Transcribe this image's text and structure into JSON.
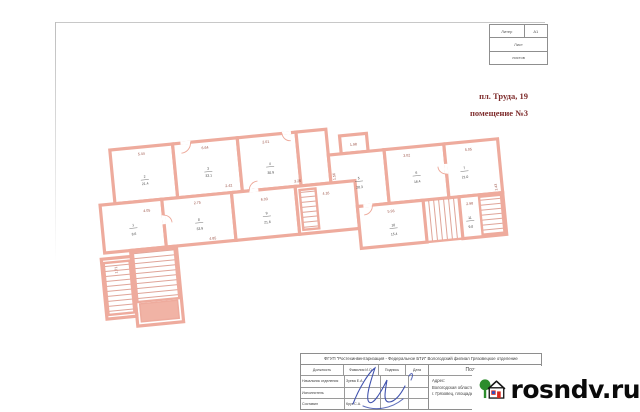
{
  "annotations": {
    "line1": "пл. Труда, 19",
    "line2": "помещение №3",
    "color": "#7f2d2d"
  },
  "stamp_table": {
    "row1_left": "Литер",
    "row1_right": "А1",
    "row2": "Лист",
    "row3": "листов"
  },
  "title_block": {
    "org": "ФГУП \"Ростехинвентаризация - Федеральное БТИ\" Вологодский филиал Грязовецкое отделение",
    "doc_title": "Поэтажный план",
    "address_label": "Адрес:",
    "address_line1": "Вологодская область,",
    "address_line2": "г. Грязовец, площадь Труда, 19",
    "col_headers": [
      "Должность",
      "Фамилия И.О.",
      "Подпись",
      "Дата"
    ],
    "rows": [
      {
        "role": "Начальник отделения",
        "name": "Зуева Е.А.",
        "date": ""
      },
      {
        "role": "Исполнитель",
        "name": "",
        "date": ""
      },
      {
        "role": "Составил",
        "name": "Круг С.А.",
        "date": ""
      }
    ]
  },
  "watermark": {
    "text": "rosndv.ru",
    "tree_color": "#2c8c2c",
    "door_color": "#d8281c",
    "window_color": "#2b50c8"
  },
  "plan": {
    "wall_color": "#eeab9d",
    "dims": [
      "5.44",
      "6.64",
      "2.01",
      "1.98",
      "3.02",
      "5.05",
      "4.05",
      "2.75",
      "6.03",
      "5.93",
      "2.98",
      "4.16",
      "1.56",
      "2.42",
      "4.85",
      "1.71",
      "3.26",
      "1.43"
    ],
    "rooms": [
      {
        "num": "2",
        "area": "21.4"
      },
      {
        "num": "3",
        "area": "33.1"
      },
      {
        "num": "4",
        "area": "30.9"
      },
      {
        "num": "5",
        "area": "20.3"
      },
      {
        "num": "6",
        "area": "16.4"
      },
      {
        "num": "7",
        "area": "21.0"
      },
      {
        "num": "1",
        "area": "8.6"
      },
      {
        "num": "8",
        "area": "33.9"
      },
      {
        "num": "9",
        "area": "21.6"
      },
      {
        "num": "10",
        "area": "15.4"
      },
      {
        "num": "11",
        "area": "9.8"
      }
    ]
  }
}
